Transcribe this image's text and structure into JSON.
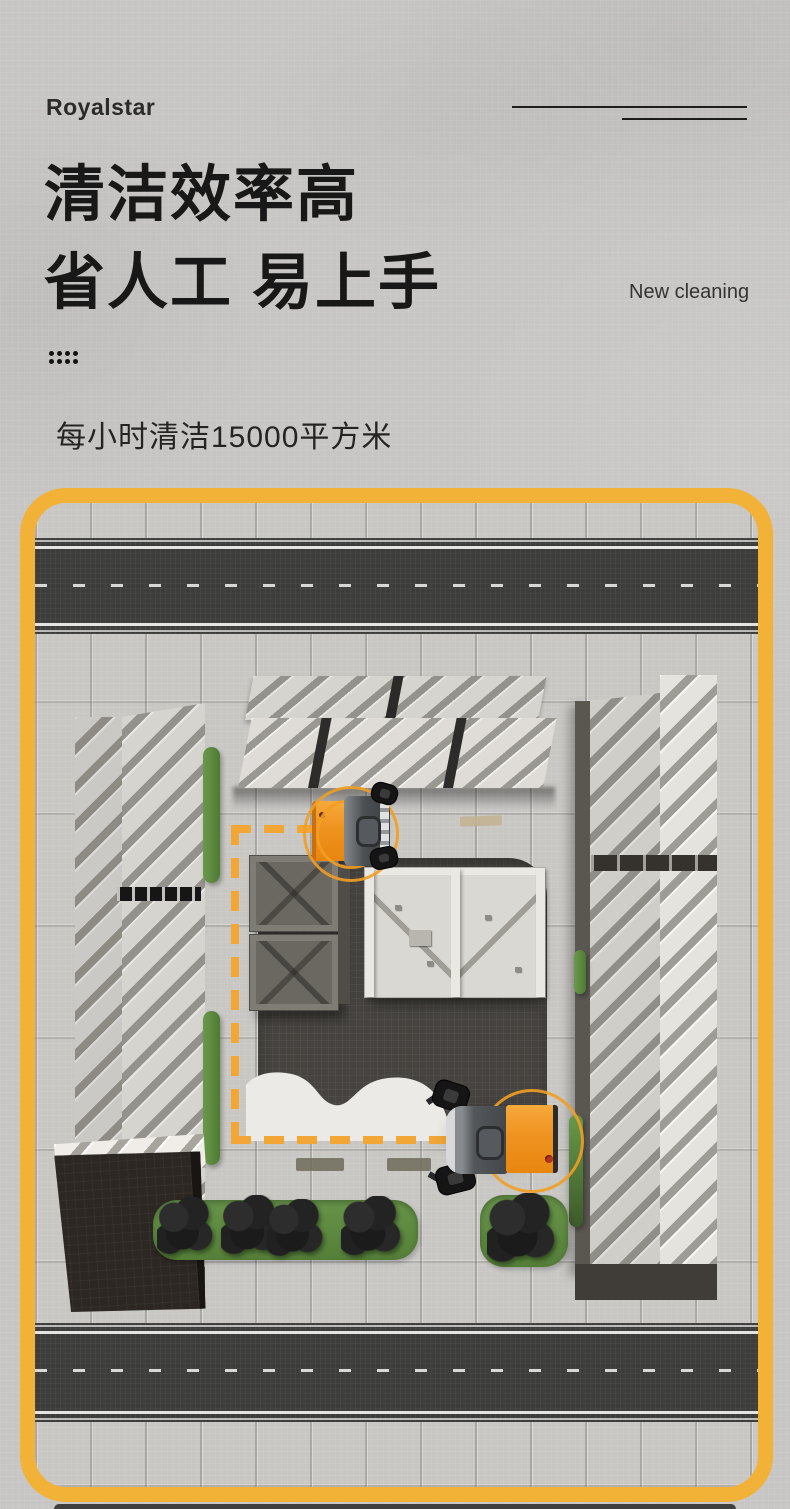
{
  "header": {
    "logo": "Royalstar"
  },
  "hero": {
    "title_line1": "清洁效率高",
    "title_line2": "省人工 易上手",
    "tagline_en": "New cleaning",
    "subtitle": "每小时清洁15000平方米"
  },
  "scene": {
    "machines_visible": 2,
    "colors": {
      "frame_accent": "#F2B137",
      "route_dashes": "#F1A636",
      "machine_orange": "#F0931C",
      "road_asphalt": "#3D3D3C",
      "plaza_dark": "#474440",
      "greenery": "#5E8C3E",
      "pavement": "#C8C7C4"
    }
  }
}
